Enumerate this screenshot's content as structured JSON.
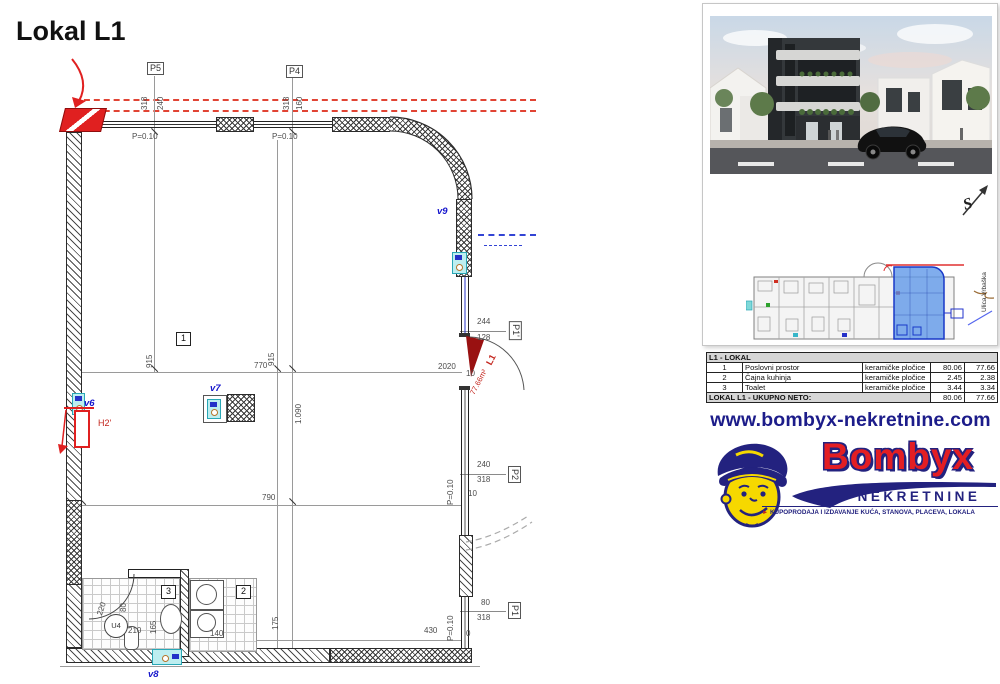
{
  "title": "Lokal L1",
  "plan": {
    "markers": {
      "p5": "P5",
      "p4": "P4",
      "p2": "P2",
      "p1": "P1",
      "p1p": "P1'"
    },
    "rooms": {
      "r1": "1",
      "r2": "2",
      "r3": "3"
    },
    "vents": {
      "v6": "v6",
      "v7": "v7",
      "v8": "v8",
      "v9": "v9"
    },
    "annotations": {
      "radiator": "H2'",
      "unit": "L1",
      "unit_area": "77.66m²",
      "u4": "U4"
    },
    "dims": {
      "p5_318": "318",
      "p5_240": "240",
      "p5_p": "P=0.10",
      "p4_318": "318",
      "p4_160": "160",
      "p4_p": "P=0.10",
      "d915a": "915",
      "d915b": "915",
      "d770": "770",
      "d1090": "1.090",
      "d790": "790",
      "d175": "175",
      "d220": "220",
      "d80a": "80",
      "d210": "210",
      "d165": "165",
      "d140": "140",
      "d430": "430",
      "d244": "244",
      "d128": "128",
      "d2020": "2020",
      "d10a": "10",
      "p2_240": "240",
      "p2_318": "318",
      "p2_p": "P=0.10",
      "p2_10": "10",
      "p1_80": "80",
      "p1_318": "318",
      "p1_p": "P=0.10",
      "p1_0": "0"
    }
  },
  "siteplan": {
    "street": "Ulica Vrbaška",
    "north": "S"
  },
  "table": {
    "header": "L1 - LOKAL",
    "rows": [
      {
        "num": "1",
        "name": "Poslovni prostor",
        "material": "keramičke pločice",
        "area": "80.06",
        "net": "77.66"
      },
      {
        "num": "2",
        "name": "Čajna kuhinja",
        "material": "keramičke pločice",
        "area": "2.45",
        "net": "2.38"
      },
      {
        "num": "3",
        "name": "Toalet",
        "material": "keramičke pločice",
        "area": "3.44",
        "net": "3.34"
      }
    ],
    "footer": {
      "label": "LOKAL L1 - UKUPNO NETO:",
      "area": "80.06",
      "net": "77.66"
    }
  },
  "branding": {
    "url": "www.bombyx-nekretnine.com",
    "brand": "Bombyx",
    "brand_sub": "NEKRETNINE",
    "tagline_arrow": "►",
    "tagline": "KUPOPRODAJA I IZDAVANJE KUĆA, STANOVA, PLACEVA, LOKALA"
  },
  "colors": {
    "accent_red": "#e14434",
    "accent_blue": "#2330c6",
    "navy": "#23227f",
    "brand_red": "#e31e23",
    "highlight_blue": "#5a96eb"
  }
}
